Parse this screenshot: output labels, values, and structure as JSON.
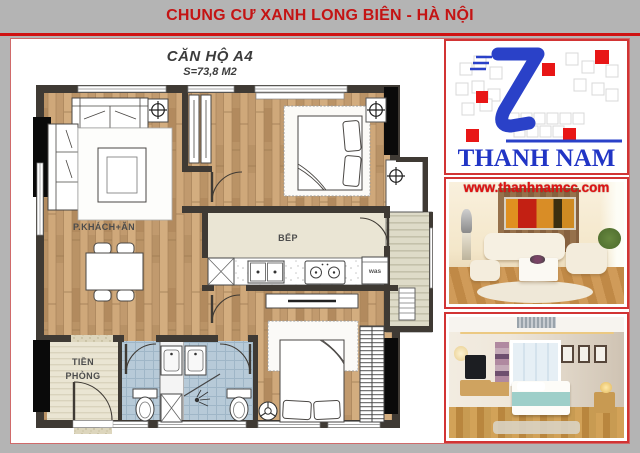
{
  "header": {
    "title": "CHUNG CƯ XANH LONG BIÊN - HÀ NỘI"
  },
  "floor_plan": {
    "title": "CĂN HỘ A4",
    "area": "S=73,8 M2",
    "labels": {
      "living_dining": "P.KHÁCH+ĂN",
      "kitchen": "BẾP",
      "hall_line1": "TIỀN",
      "hall_line2": "PHÒNG",
      "washing_machine": "was"
    }
  },
  "brand": {
    "name": "THANH NAM",
    "website": "www.thanhnamcc.com"
  },
  "colors": {
    "accent_red": "#cf1212",
    "brand_blue": "#2a41c8",
    "wall_dark": "#3f3a34"
  }
}
